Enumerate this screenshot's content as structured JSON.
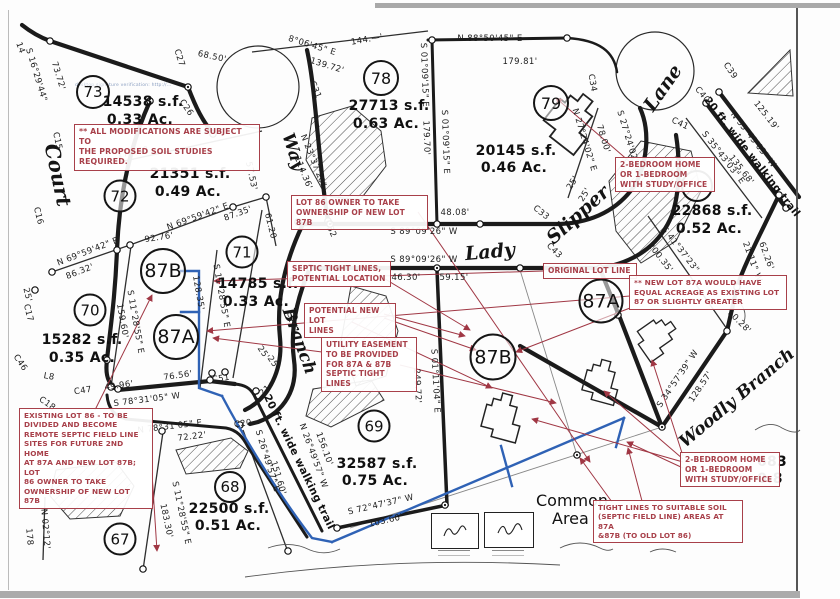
{
  "watermark": "desktop signature verification: http://…",
  "streets": {
    "court": "Court",
    "way": "Way",
    "lady": "Lady",
    "slipper": "Slipper",
    "lane": "Lane",
    "branch": "Branch",
    "woodly_branch": "Woodly Branch",
    "walking_trail_ne": "20 ft. wide walking trail",
    "walking_trail_sw": "20 ft. wide walking trail",
    "common_area_line1": "Common",
    "common_area_line2": "Area"
  },
  "lots": {
    "l67": {
      "num": "67"
    },
    "l68": {
      "num": "68",
      "sf": "22500 s.f.",
      "ac": "0.51 Ac."
    },
    "l69": {
      "num": "69",
      "sf": "32587 s.f.",
      "ac": "0.75 Ac."
    },
    "l70": {
      "num": "70",
      "sf": "15282 s.f.",
      "ac": "0.35 Ac."
    },
    "l71": {
      "num": "71",
      "sf": "14785 s.f.",
      "ac": "0.33 Ac."
    },
    "l72": {
      "num": "72",
      "sf": "21351 s.f.",
      "ac": "0.49 Ac."
    },
    "l73": {
      "num": "73",
      "sf": "14538 s.f.",
      "ac": "0.33 Ac."
    },
    "l78": {
      "num": "78",
      "sf": "27713 s.f.",
      "ac": "0.63 Ac."
    },
    "l79": {
      "num": "79",
      "sf": "20145 s.f.",
      "ac": "0.46 Ac."
    },
    "l80": {
      "sf": "22868 s.f.",
      "ac": "0.52 Ac."
    },
    "l87A_left": {
      "num": "87A"
    },
    "l87B_left": {
      "num": "87B"
    },
    "l87A_right": {
      "num": "87A"
    },
    "l87B_right": {
      "num": "87B"
    },
    "edge_partial_sf": "683",
    "edge_partial_ac": "0.8"
  },
  "annotations": {
    "soil": {
      "lines": [
        "** ALL MODIFICATIONS ARE SUBJECT TO",
        "THE PROPOSED SOIL STUDIES REQUIRED."
      ]
    },
    "lot86_owner": {
      "lines": [
        "LOT 86 OWNER TO TAKE",
        "OWNERSHIP OF NEW LOT 87B"
      ]
    },
    "septic_location": {
      "lines": [
        "SEPTIC TIGHT LINES,",
        "POTENTIAL LOCATION"
      ]
    },
    "potential_lines": {
      "lines": [
        "POTENTIAL NEW LOT",
        "LINES"
      ]
    },
    "utility_easement": {
      "lines": [
        "UTILITY EASEMENT",
        "TO BE PROVIDED",
        "FOR 87A & 87B",
        "SEPTIC TIGHT LINES"
      ]
    },
    "bedroom_top": {
      "lines": [
        "2-BEDROOM HOME",
        "OR 1-BEDROOM",
        "WITH STUDY/OFFICE"
      ]
    },
    "original_lot_line": {
      "lines": [
        "ORIGINAL LOT LINE"
      ]
    },
    "new_lot_87a": {
      "lines": [
        "** NEW LOT 87A WOULD HAVE",
        "EQUAL ACREAGE AS EXISTING LOT",
        "87 OR SLIGHTLY GREATER"
      ]
    },
    "existing_lot_86": {
      "lines": [
        "EXISTING LOT 86 - TO BE",
        "DIVIDED AND BECOME",
        "REMOTE SEPTIC FIELD LINE",
        "SITES FOR FUTURE 2ND HOME",
        "AT 87A AND NEW LOT 87B; LOT",
        "86 OWNER TO TAKE",
        "OWNERSHIP OF NEW LOT 87B"
      ]
    },
    "bedroom_bottom": {
      "lines": [
        "2-BEDROOM HOME",
        "OR 1-BEDROOM",
        "WITH STUDY/OFFICE"
      ]
    },
    "tight_lines": {
      "lines": [
        "TIGHT LINES TO SUITABLE SOIL",
        "(SEPTIC FIELD LINE) AREAS AT 87A",
        "&87B (TO OLD LOT 86)"
      ]
    }
  },
  "bearings": {
    "m01": "8°06'45\" E",
    "m02": "139.72'",
    "m03": "68.50'",
    "m04": "S 16°29'44\"",
    "m05": "73.72'",
    "m06": "14",
    "m07": "C15",
    "m08": "C27",
    "m09": "C26",
    "m10": "C31",
    "m11": "173.48",
    "m12": "N 88°50'45\" E",
    "m13": "179.81'",
    "m14": "144.—'",
    "m15": "S 01°09'15\" E",
    "m16": "179.70'",
    "m17": "S 01°09'15\" E",
    "m18": "48.08'",
    "m19": "S 89°09'26\" W",
    "m20": "S 89°09'26\" W",
    "m21": "46.30'",
    "m22": "59.15'",
    "m23": "C32",
    "m24": "C33",
    "m25": "C43",
    "m26": "C34",
    "m27": "C39",
    "m28": "C40",
    "m29": "C41",
    "m30": "N 27°24'02\" E",
    "m31": "78.00'",
    "m32": "S 27°24'02\" W",
    "m33": "25'",
    "m34": "25'",
    "m35": "N 35°43'03\" W",
    "m36": "125.19'",
    "m37": "S 35°43'03\" E",
    "m38": "135.68'",
    "m39": "S 41°37'23\"",
    "m40": "200.35'",
    "m41": "21'11\" W",
    "m42": "62.26'",
    "m43": "10.28'",
    "m44": "S 34°57'39\" W",
    "m45": "128.57'",
    "m46": "C16",
    "m47": "25'",
    "m48": "C17",
    "m49": "C46",
    "m50": "L8",
    "m51": "C47",
    "m52": "49.96'",
    "m53": "S 78°31'05\" W",
    "m54": "N 78°31'05\" E",
    "m55": "72.22'",
    "m56": "76.56'",
    "m57": "86.32'",
    "m58": "N 69°59'42\" E",
    "m59": "92.76'",
    "m60": "N 69°59'42\" E",
    "m61": "87.35'",
    "m62": "61.20",
    "m63": "S 11°28'55\" E",
    "m64": "159.60'",
    "m65": "S 11°28'55\" E",
    "m66": "128.35'",
    "m67": "S 11°28'55\" E",
    "m68": "183.30'",
    "m69": "N 02°12'",
    "m70": "178",
    "m71": "C18",
    "m72": "C20",
    "m73": "C21",
    "m74": "C51",
    "m75": "25'",
    "m76": "25'",
    "m77": "C24",
    "m78": "S 26°49'57\" E",
    "m79": "151.60'",
    "m80": "N 26°49'57\" W",
    "m81": "156.10'",
    "m82": "S 72°47'37\" W",
    "m83": "103.60'",
    "m84": "S 01°11'04\" E",
    "m85": "249.72'",
    "m86": "57.53'",
    "m87": "N 23°37'20\"",
    "m88": "114.36'"
  }
}
